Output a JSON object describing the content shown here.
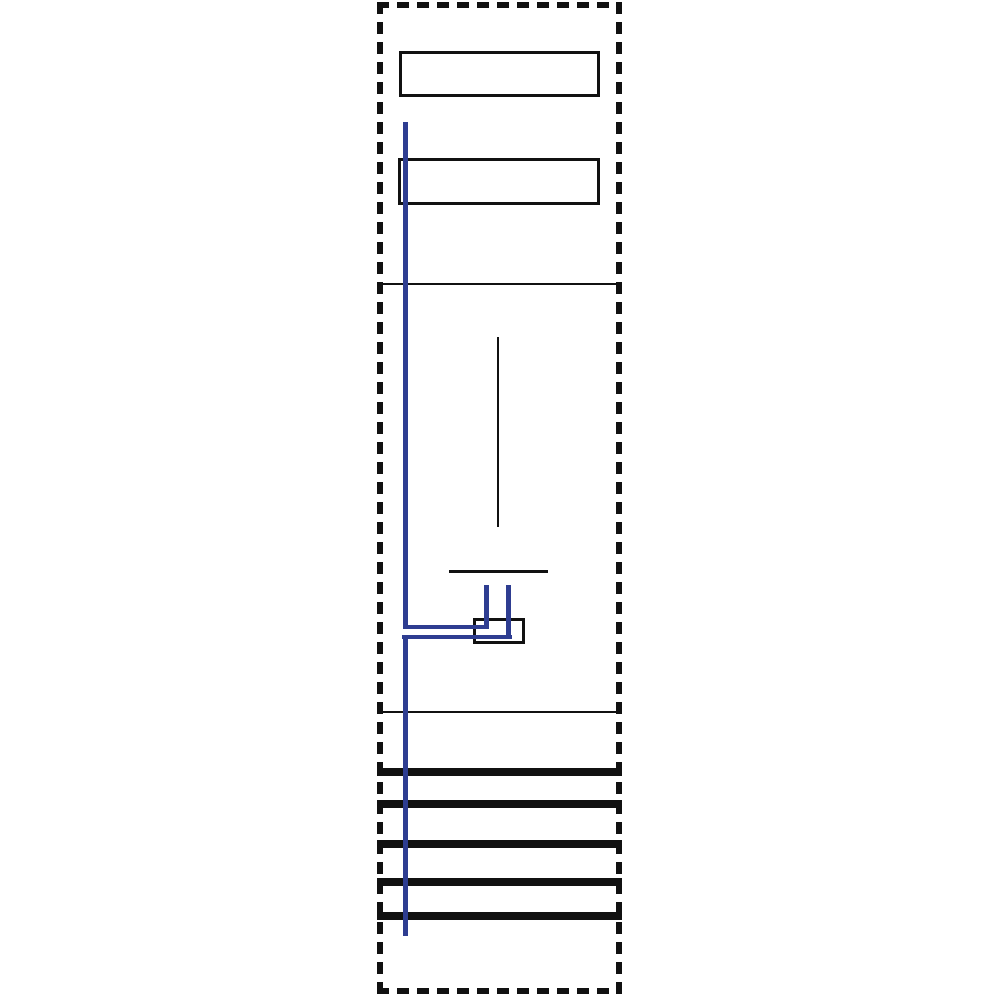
{
  "diagram": {
    "kind": "meter-panel-wiring-diagram",
    "colors": {
      "outline": "#111111",
      "lines": "#111111",
      "wire": "#2e3d91",
      "background": "#ffffff"
    },
    "elements": [
      "panel-outline-dashed",
      "cover-plate-top",
      "cover-plate-upper",
      "section-divider-top",
      "meter-marker-line",
      "meter-terminal-line",
      "terminal-box",
      "section-divider-bottom",
      "phase-wire-bus",
      "phase-wire-branch-upper",
      "phase-wire-branch-lower",
      "phase-wire-stub-left",
      "phase-wire-stub-right"
    ],
    "busbars": {
      "count": 5,
      "y_positions": [
        768,
        800,
        840,
        878,
        912
      ]
    }
  }
}
